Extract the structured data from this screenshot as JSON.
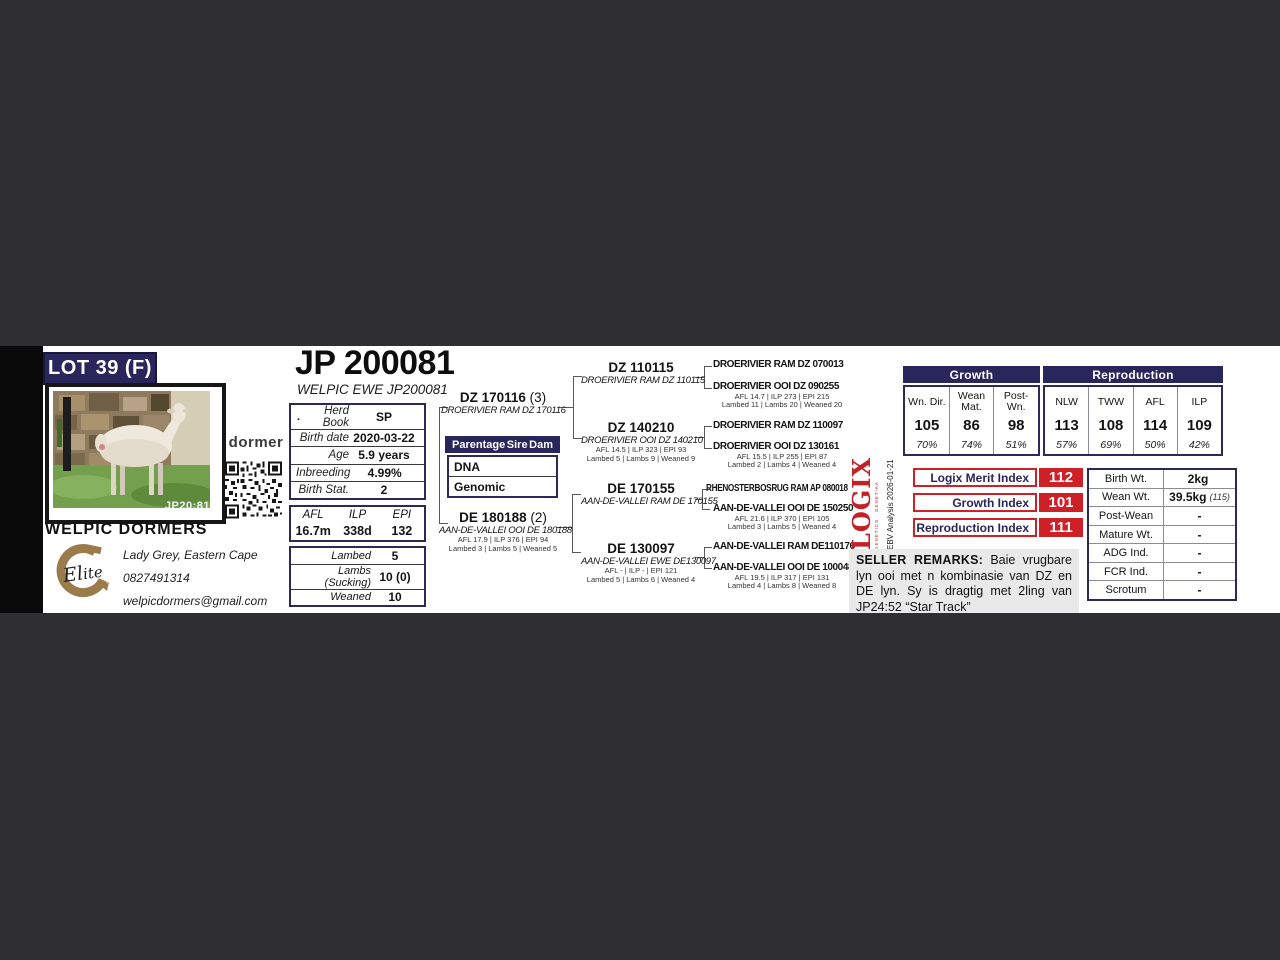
{
  "lot": {
    "label": "LOT 39 (F)"
  },
  "photo": {
    "watermark": "JP20:81"
  },
  "brand": {
    "dormer": "dormer",
    "elite": "Elite"
  },
  "breeder": {
    "name": "WELPIC DORMERS",
    "location": "Lady Grey, Eastern Cape",
    "phone": "0827491314",
    "email": "welpicdormers@gmail.com"
  },
  "animal": {
    "id": "JP 200081",
    "name": "WELPIC EWE JP200081"
  },
  "info_table": {
    "rows": [
      {
        "prefix": ".",
        "label": "Herd Book",
        "value": "SP"
      },
      {
        "prefix": "",
        "label": "Birth date",
        "value": "2020-03-22"
      },
      {
        "prefix": "",
        "label": "Age",
        "value": "5.9 years"
      },
      {
        "prefix": "",
        "label": "Inbreeding",
        "value": "4.99%"
      },
      {
        "prefix": "",
        "label": "Birth Stat.",
        "value": "2"
      }
    ]
  },
  "afl_box": {
    "headers": [
      "AFL",
      "ILP",
      "EPI"
    ],
    "values": [
      "16.7m",
      "338d",
      "132"
    ]
  },
  "lamb_box": {
    "rows": [
      {
        "label": "Lambed",
        "value": "5"
      },
      {
        "label": "Lambs (Sucking)",
        "value": "10 (0)"
      },
      {
        "label": "Weaned",
        "value": "10"
      }
    ]
  },
  "parentage": {
    "headers": [
      "Parentage",
      "Sire",
      "Dam"
    ],
    "rows": [
      "DNA",
      "Genomic"
    ]
  },
  "pedigree": {
    "sire": {
      "id": "DZ 170116",
      "suffix": "(3)",
      "name": "DROERIVIER RAM DZ 170116"
    },
    "dam": {
      "id": "DE 180188",
      "suffix": "(2)",
      "name": "AAN-DE-VALLEI OOI DE 180188",
      "stats1": "AFL 17.9 | ILP 376 | EPI 94",
      "stats2": "Lambed 3 | Lambs 5 | Weaned 5"
    },
    "gen2": [
      {
        "id": "DZ 110115",
        "name": "DROERIVIER RAM DZ 110115",
        "stats1": "",
        "stats2": ""
      },
      {
        "id": "DZ 140210",
        "name": "DROERIVIER OOI DZ 140210",
        "stats1": "AFL 14.5 | ILP 323 | EPI 93",
        "stats2": "Lambed 5 | Lambs 9 | Weaned 9"
      },
      {
        "id": "DE 170155",
        "name": "AAN-DE-VALLEI RAM DE 170155",
        "stats1": "",
        "stats2": ""
      },
      {
        "id": "DE 130097",
        "name": "AAN-DE-VALLEI EWE DE130097",
        "stats1": "AFL - | ILP - | EPI 121",
        "stats2": "Lambed 5 | Lambs 6 | Weaned 4"
      }
    ],
    "gen3": [
      {
        "name": "DROERIVIER RAM DZ 070013",
        "stats1": "",
        "stats2": ""
      },
      {
        "name": "DROERIVIER OOI DZ 090255",
        "stats1": "AFL 14.7 | ILP 273 | EPI 215",
        "stats2": "Lambed 11 | Lambs 20 | Weaned 20"
      },
      {
        "name": "DROERIVIER RAM DZ 110097",
        "stats1": "",
        "stats2": ""
      },
      {
        "name": "DROERIVIER OOI DZ 130161",
        "stats1": "AFL 15.5 | ILP 255 | EPI 87",
        "stats2": "Lambed 2 | Lambs 4 | Weaned 4"
      },
      {
        "name": "RHENOSTERBOSRUG RAM AP 080018",
        "stats1": "",
        "stats2": ""
      },
      {
        "name": "AAN-DE-VALLEI OOI DE 150250",
        "stats1": "AFL 21.6 | ILP 370 | EPI 105",
        "stats2": "Lambed 3 | Lambs 5 | Weaned 4"
      },
      {
        "name": "AAN-DE-VALLEI RAM DE110176",
        "stats1": "",
        "stats2": ""
      },
      {
        "name": "AAN-DE-VALLEI OOI DE 100048",
        "stats1": "AFL 19.5 | ILP 317 | EPI 131",
        "stats2": "Lambed 4 | Lambs 8 | Weaned 8"
      }
    ]
  },
  "ebv": {
    "group_headers": [
      "Growth",
      "Reproduction"
    ],
    "columns": [
      {
        "header": "Wn. Dir.",
        "value": "105",
        "acc": "70%"
      },
      {
        "header": "Wean Mat.",
        "value": "86",
        "acc": "74%"
      },
      {
        "header": "Post- Wn.",
        "value": "98",
        "acc": "51%"
      },
      {
        "header": "NLW",
        "value": "113",
        "acc": "57%"
      },
      {
        "header": "TWW",
        "value": "108",
        "acc": "69%"
      },
      {
        "header": "AFL",
        "value": "114",
        "acc": "50%"
      },
      {
        "header": "ILP",
        "value": "109",
        "acc": "42%"
      }
    ]
  },
  "logix": {
    "wordmark": "LOGIX",
    "tagline": "GENETICS · GENETIKA",
    "analysis": "EBV Analysis 2026-01-21"
  },
  "indexes": [
    {
      "label": "Logix Merit Index",
      "value": "112"
    },
    {
      "label": "Growth Index",
      "value": "101"
    },
    {
      "label": "Reproduction Index",
      "value": "111"
    }
  ],
  "weights": {
    "rows": [
      {
        "label": "Birth Wt.",
        "value": "2kg",
        "note": ""
      },
      {
        "label": "Wean Wt.",
        "value": "39.5kg",
        "note": "(115)"
      },
      {
        "label": "Post-Wean",
        "value": "-",
        "note": ""
      },
      {
        "label": "Mature Wt.",
        "value": "-",
        "note": ""
      },
      {
        "label": "ADG Ind.",
        "value": "-",
        "note": ""
      },
      {
        "label": "FCR Ind.",
        "value": "-",
        "note": ""
      },
      {
        "label": "Scrotum",
        "value": "-",
        "note": ""
      }
    ]
  },
  "remarks": {
    "title": "SELLER REMARKS:",
    "text": " Baie vrugbare lyn ooi met n kombinasie van DZ en DE lyn. Sy is dragtig met 2ling van JP24:52 “Star Track”"
  },
  "colors": {
    "navy": "#28265b",
    "red": "#ce2127",
    "page_bg": "#2f2f31"
  }
}
